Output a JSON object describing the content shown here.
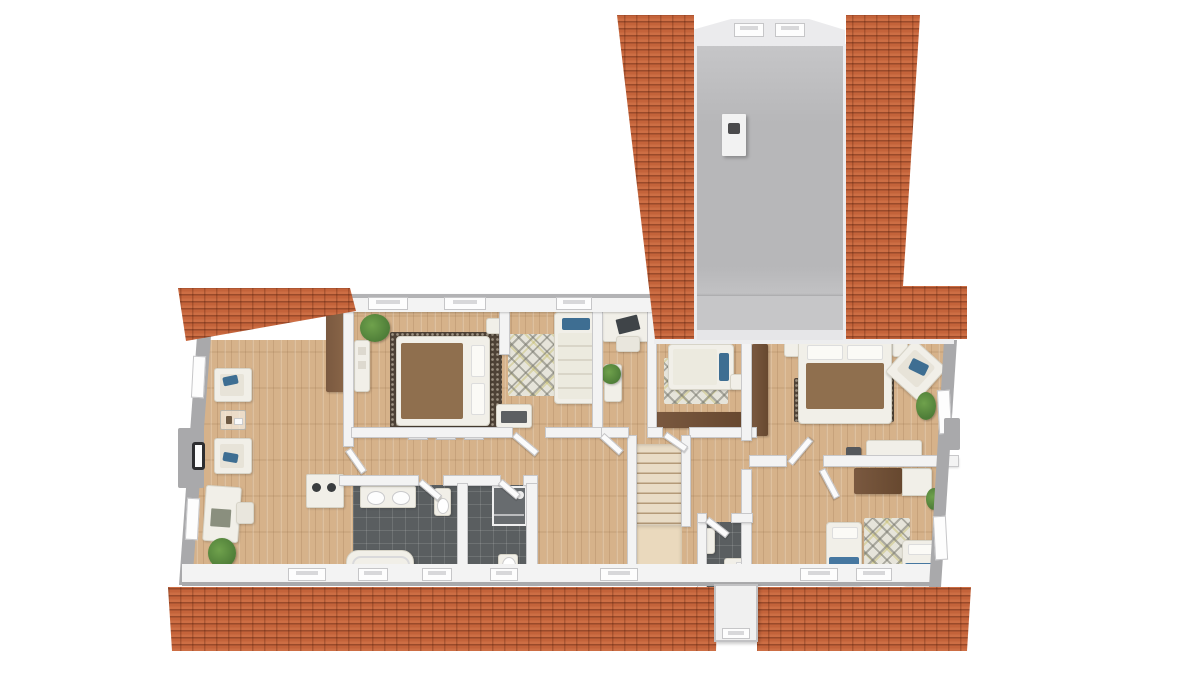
{
  "scene": {
    "title": "3D floor plan render — upper storey, top-down view",
    "background": "#ffffff",
    "has_text": false
  },
  "colors": {
    "roof": "#c4633a",
    "wood": "#d6b28a",
    "wall_outer": "#a9a9ab",
    "wall_inner": "#f3f3f3",
    "wall_edge": "#c8c8ca",
    "attic": "#b7b7b9",
    "attic_light": "#c6c6c8",
    "gable": "#ebebed",
    "tile": "#5a5e60",
    "rug_dark": "#4e4236",
    "rug_light": "#e6e4da",
    "furn_white": "#f1efe8",
    "blanket_brown": "#8f6f4e",
    "pillow_blue": "#3e6e92",
    "kids_blue": "#4677a0",
    "furn_brown": "#7a5940",
    "furn_brown_dark": "#67482f",
    "plant_green": "#4e7d38",
    "plant_green_light": "#6fa14c",
    "stairs": "#e9dcc6",
    "stairs_line": "#b49a78",
    "landing": "#ead9bd",
    "blotter_green": "#8a8f7e",
    "laptop_dark": "#3f4448"
  },
  "rooms": [
    {
      "name": "attic-wing",
      "floor": "concrete-gray",
      "items": [
        "chimney",
        "gable-window",
        "gable-window"
      ]
    },
    {
      "name": "living-area",
      "floor": "wood",
      "items": [
        "armchair",
        "armchair",
        "coffee-table",
        "desk",
        "desk-chair",
        "floor-plant",
        "wardrobe",
        "kitchenette-counter",
        "bay-window"
      ]
    },
    {
      "name": "bedroom-1",
      "floor": "wood",
      "items": [
        "double-bed",
        "dark-patterned-rug",
        "plant",
        "shelf-unit",
        "dresser",
        "nightstand"
      ]
    },
    {
      "name": "bedroom-2",
      "floor": "wood",
      "items": [
        "single-bed",
        "diamond-rug",
        "desk",
        "laptop",
        "desk-chair",
        "plant-stand"
      ]
    },
    {
      "name": "bedroom-3",
      "floor": "wood",
      "items": [
        "single-bed",
        "diamond-rug",
        "nightstand",
        "sideboard"
      ]
    },
    {
      "name": "master-bedroom",
      "floor": "wood",
      "items": [
        "double-bed",
        "dark-patterned-rug",
        "nightstand",
        "nightstand",
        "armchair",
        "plant",
        "desk",
        "printer",
        "wardrobe"
      ]
    },
    {
      "name": "kids-bedroom",
      "floor": "wood",
      "items": [
        "single-bed",
        "single-bed",
        "diamond-rug",
        "dresser",
        "plant"
      ]
    },
    {
      "name": "bathroom-1",
      "floor": "dark-tile",
      "items": [
        "double-vanity",
        "bathtub",
        "toilet"
      ]
    },
    {
      "name": "bathroom-2",
      "floor": "dark-tile",
      "items": [
        "shower",
        "toilet"
      ]
    },
    {
      "name": "wc",
      "floor": "dark-tile",
      "items": [
        "sink",
        "toilet",
        "dormer-window"
      ]
    },
    {
      "name": "hallway",
      "floor": "wood",
      "items": [
        "staircase",
        "wall-cabinet",
        "wall-cabinet",
        "wall-cabinet",
        "landing"
      ]
    }
  ],
  "window_counts": {
    "top_wall": 3,
    "bottom_wall": 7,
    "left_wall": 2,
    "right_wall": 2,
    "gable": 2,
    "wc_dormer": 1
  }
}
